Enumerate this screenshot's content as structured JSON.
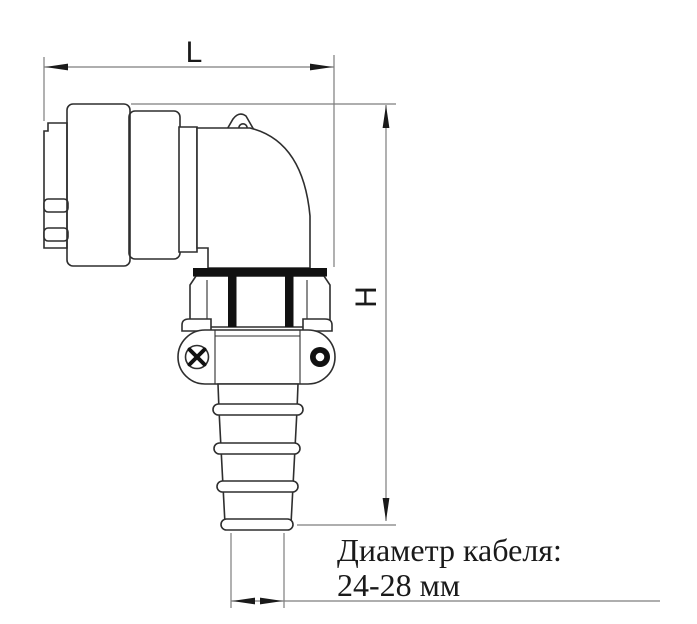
{
  "drawing": {
    "kind": "right-angle circular connector with cable gland, side view",
    "dimensions": {
      "length_label": "L",
      "height_label": "H"
    },
    "note": {
      "line1": "Диаметр кабеля:",
      "line2": "24-28 мм"
    },
    "colors": {
      "background": "#ffffff",
      "outline": "#2e2e2e",
      "dimension": "#7d7d7d",
      "arrow": "#1a1a1a",
      "band": "#111111",
      "text": "#1a1a1a"
    }
  }
}
